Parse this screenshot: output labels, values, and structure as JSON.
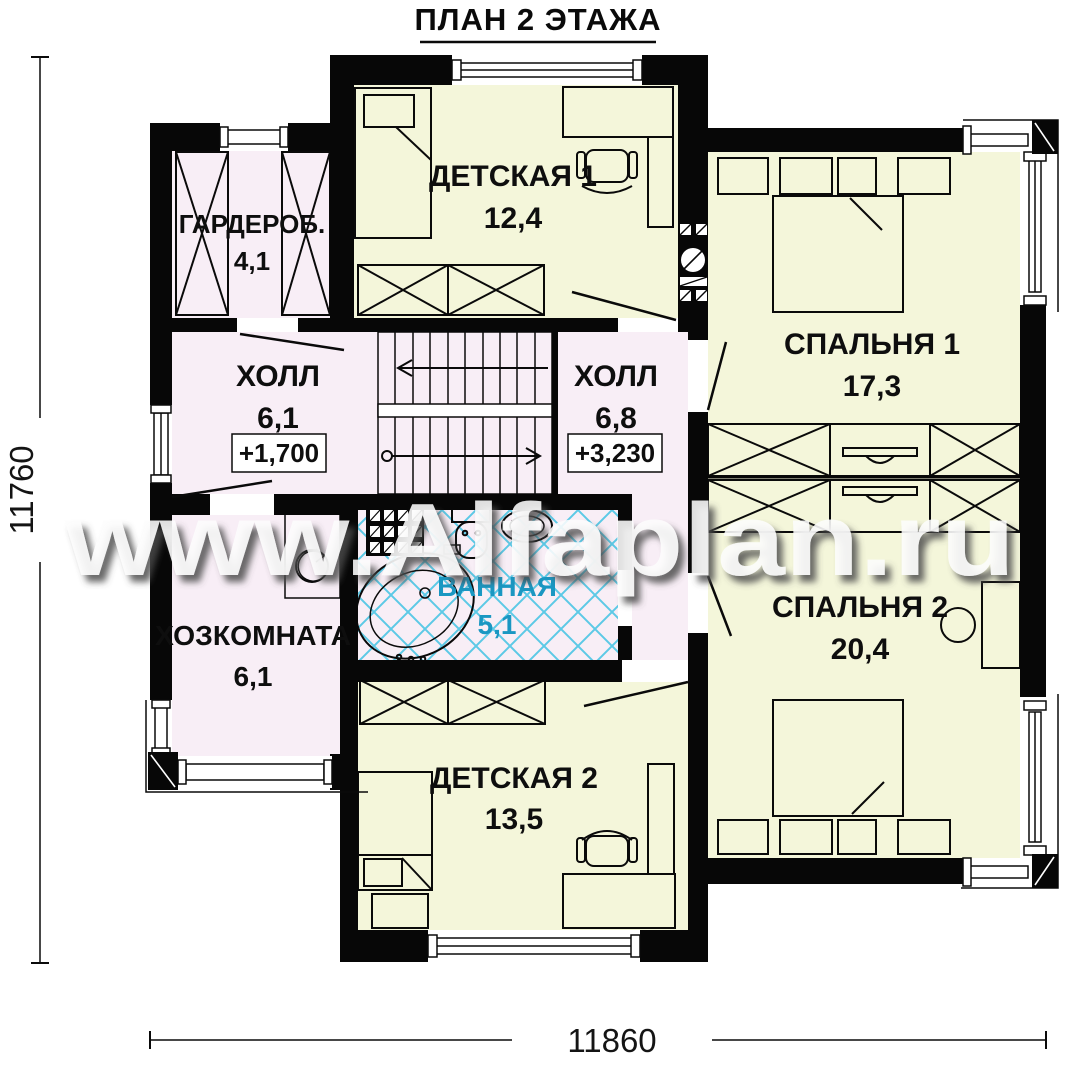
{
  "title": "ПЛАН 2 ЭТАЖА",
  "watermark": "www.Alfaplan.ru",
  "dimensions": {
    "left": "11760",
    "bottom": "11860"
  },
  "elevations": {
    "hall1": "+1,700",
    "hall2": "+3,230"
  },
  "rooms": {
    "kids1": {
      "name": "ДЕТСКАЯ 1",
      "area": "12,4"
    },
    "wardrobe": {
      "name": "ГАРДЕРОБ.",
      "area": "4,1"
    },
    "hall1": {
      "name": "ХОЛЛ",
      "area": "6,1"
    },
    "hall2": {
      "name": "ХОЛЛ",
      "area": "6,8"
    },
    "bedroom1": {
      "name": "СПАЛЬНЯ 1",
      "area": "17,3"
    },
    "bedroom2": {
      "name": "СПАЛЬНЯ 2",
      "area": "20,4"
    },
    "utility": {
      "name": "ХОЗКОМНАТА",
      "area": "6,1"
    },
    "bath": {
      "name": "ВАННАЯ",
      "area": "5,1"
    },
    "kids2": {
      "name": "ДЕТСКАЯ 2",
      "area": "13,5"
    }
  },
  "colors": {
    "wall": "#070707",
    "room_yellow": "#f4f6da",
    "room_pink": "#f8eef6",
    "bath_accent": "#1a97c2",
    "tile_cyan": "#41c3e3",
    "watermark": "#fdfdfd"
  }
}
